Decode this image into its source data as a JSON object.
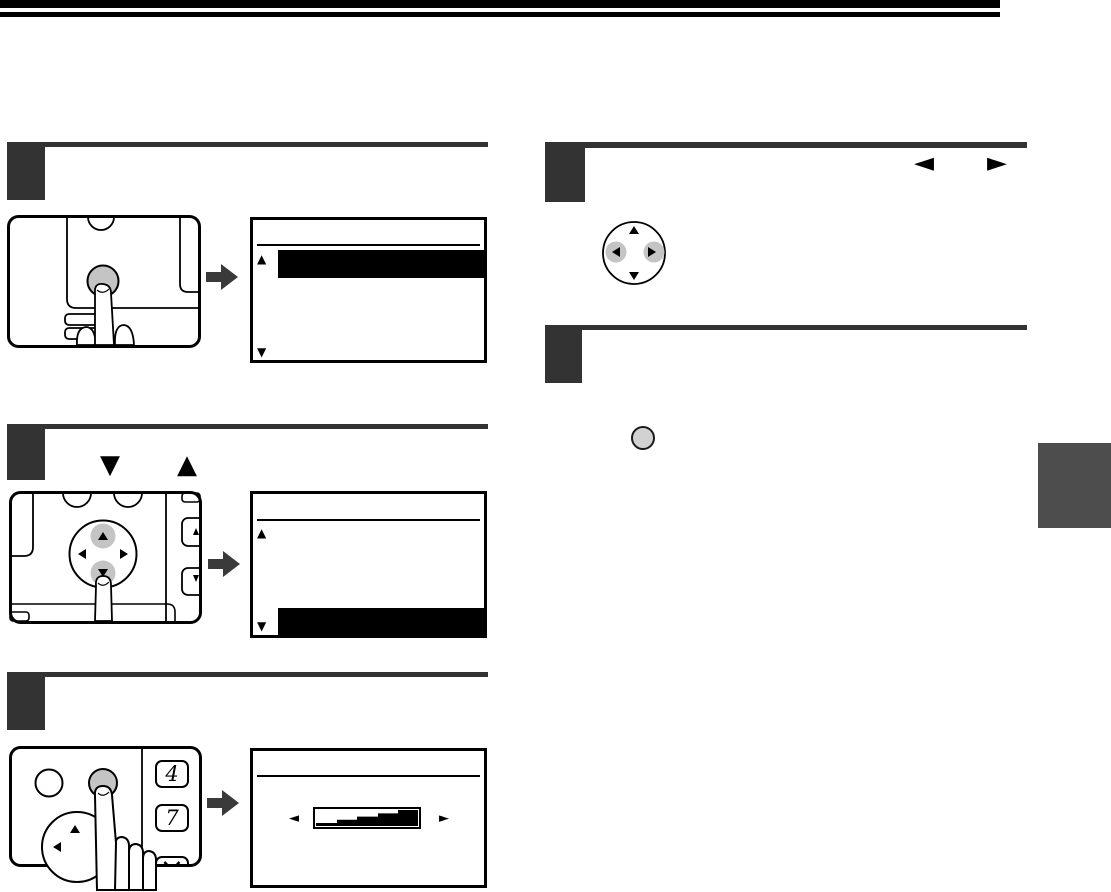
{
  "page": {
    "colors": {
      "top_bar": "#000000",
      "step_accent": "#333333",
      "flow_arrow": "#3a3a3a",
      "side_tab": "#4d4d4d",
      "pressed_button_gray": "#c4c4c4",
      "inline_button_gray": "#d2d2d2",
      "lcd_highlight": "#000000"
    }
  },
  "step2_header": {
    "down_key_glyph": "▼",
    "up_key_glyph": "▲"
  },
  "step4_header": {
    "left_key_glyph": "◄",
    "right_key_glyph": "►"
  },
  "lcd1": {
    "up_arrow": "▲",
    "down_arrow": "▼"
  },
  "lcd2": {
    "up_arrow": "▲",
    "down_arrow": "▼"
  },
  "lcd3": {
    "left_arrow": "◄",
    "right_arrow": "►"
  },
  "keypad": {
    "key_4": "4",
    "key_7": "7",
    "key_x": "×"
  }
}
